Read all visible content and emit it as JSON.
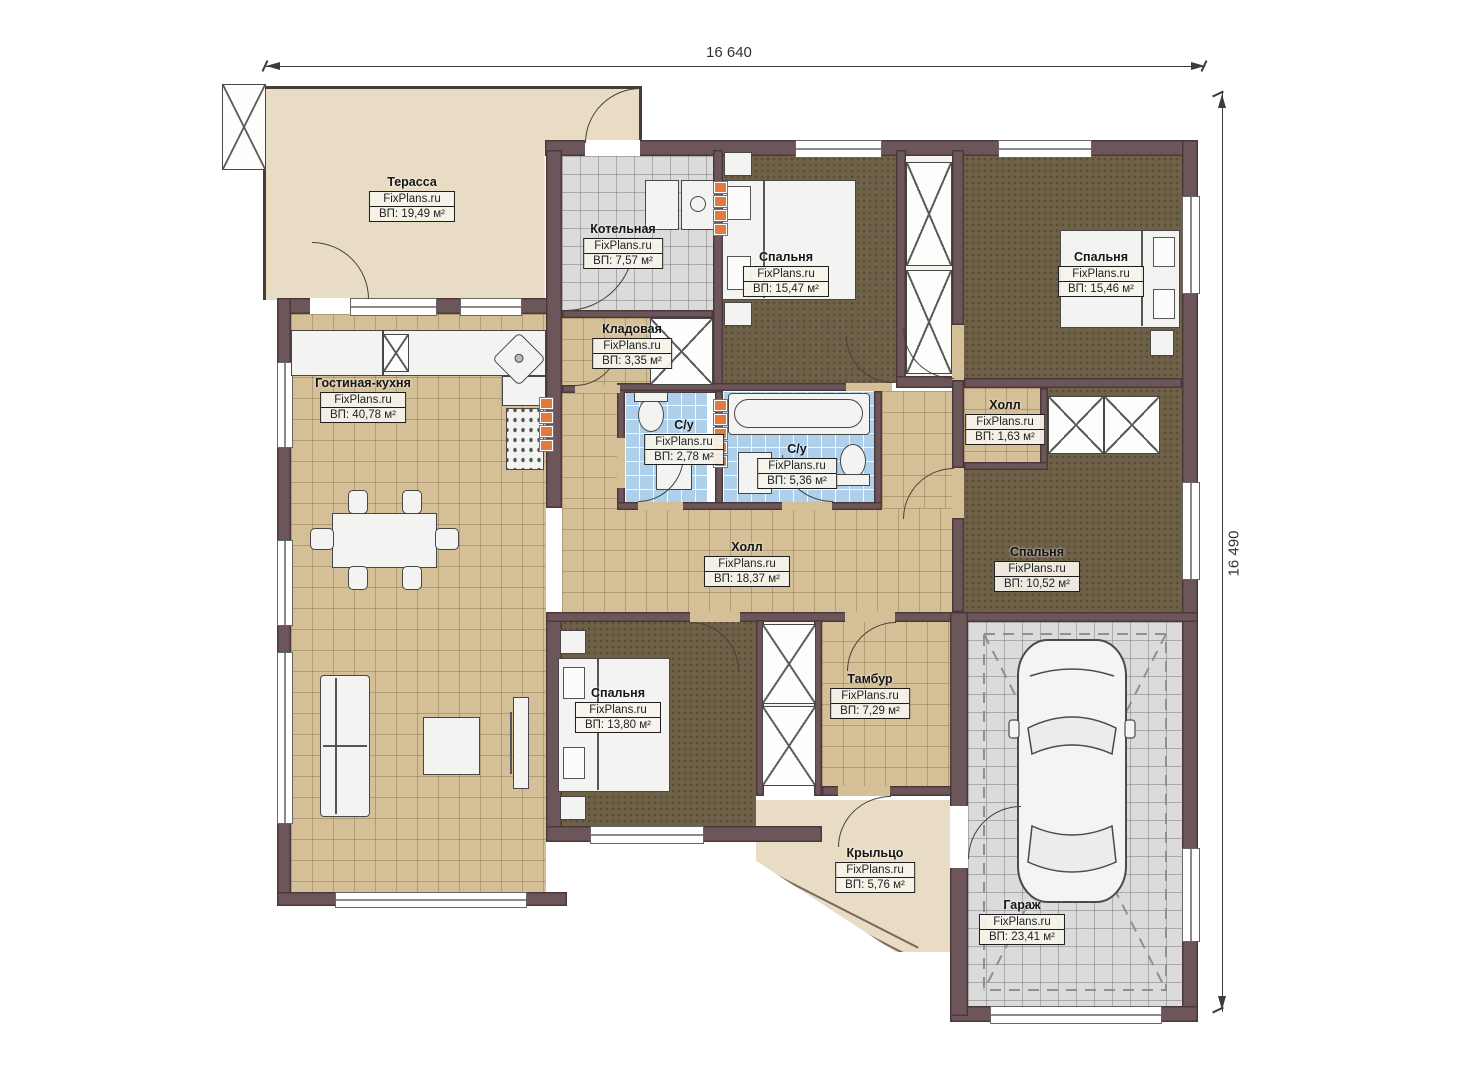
{
  "watermark": "FixPlans.ru",
  "dimensions": {
    "width_label": "16 640",
    "height_label": "16 490"
  },
  "colors": {
    "wall": "#6d565a",
    "floor_tan": "#d4bf96",
    "floor_brown": "#6f6148",
    "floor_blue": "#aed0ea",
    "floor_grey": "#dbdbdb",
    "terrace_beige": "#e8dcc4",
    "radiator_orange": "#e2793f"
  },
  "rooms": [
    {
      "name": "Терасса",
      "area": "ВП: 19,49 м²"
    },
    {
      "name": "Котельная",
      "area": "ВП: 7,57 м²"
    },
    {
      "name": "Спальня",
      "area": "ВП: 15,47 м²"
    },
    {
      "name": "Спальня",
      "area": "ВП: 15,46 м²"
    },
    {
      "name": "Кладовая",
      "area": "ВП: 3,35 м²"
    },
    {
      "name": "Гостиная-кухня",
      "area": "ВП: 40,78 м²"
    },
    {
      "name": "С/у",
      "area": "ВП: 2,78 м²"
    },
    {
      "name": "С/у",
      "area": "ВП: 5,36 м²"
    },
    {
      "name": "Холл",
      "area": "ВП: 1,63 м²"
    },
    {
      "name": "Холл",
      "area": "ВП: 18,37 м²"
    },
    {
      "name": "Спальня",
      "area": "ВП: 10,52 м²"
    },
    {
      "name": "Спальня",
      "area": "ВП: 13,80 м²"
    },
    {
      "name": "Тамбур",
      "area": "ВП: 7,29 м²"
    },
    {
      "name": "Крыльцо",
      "area": "ВП: 5,76 м²"
    },
    {
      "name": "Гараж",
      "area": "ВП: 23,41 м²"
    }
  ]
}
